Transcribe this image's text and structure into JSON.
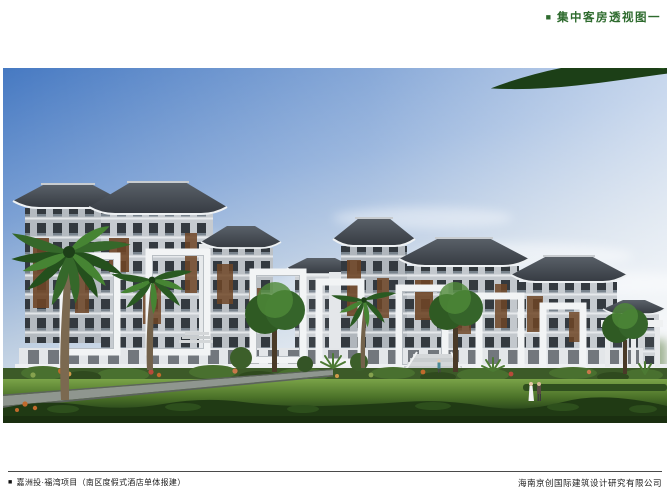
{
  "header": {
    "bullet_icon": "■",
    "title": "集中客房透视图一",
    "accent_color": "#2e6b2e"
  },
  "figure": {
    "kind": "architectural-perspective-rendering",
    "palette": {
      "sky_top": "#4679c2",
      "sky_horizon": "#e7ebef",
      "roof_dark": "#3e444b",
      "facade_light": "#c6cbd0",
      "facade_shaded": "#b0b6bc",
      "wood_accent": "#6e4526",
      "portal_frame_white": "#f2f4f5",
      "lawn_light": "#7aa348",
      "lawn_dark": "#2c4a1c",
      "palm_green": "#2e5c25"
    }
  },
  "footer": {
    "bullet_icon": "■",
    "project_label": "嘉洲投·福湾项目（南区度假式酒店单体报建）",
    "company_label": "海南京创国际建筑设计研究有限公司"
  }
}
